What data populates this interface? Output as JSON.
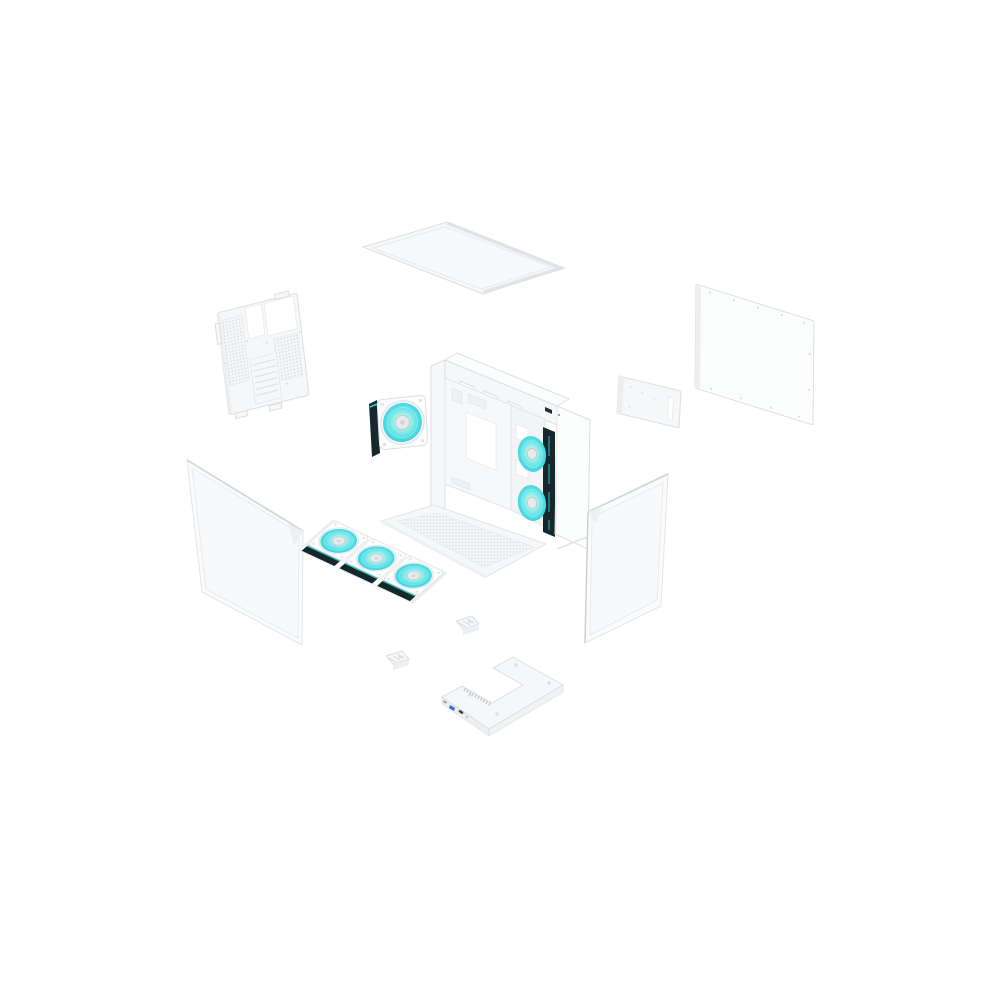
{
  "image": {
    "type": "product-render",
    "description": "Exploded isometric view of a white mid-tower ATX PC case on a white background: top dust-filter panel, vented steel side panel, solid side panel, tempered glass side and front panels, main chassis with motherboard tray and bottom mesh filter, one 120 mm turquoise ARGB rear fan, a bracket with three 120 mm turquoise ARGB fans, two small mounting brackets and a front I/O base frame with USB ports.",
    "background": "#ffffff"
  },
  "product": {
    "category": "PC case (mid-tower)",
    "finish": "white",
    "accent": "turquoise ARGB fans",
    "view": "exploded isometric"
  },
  "colors": {
    "background": "#ffffff",
    "panel_white": "#f6f7f8",
    "panel_bright": "#fcfdfd",
    "panel_shade": "#eceef0",
    "edge_line": "#dcdfe1",
    "mesh_bg": "#f3f5f6",
    "mesh_dot": "#d9dde0",
    "fan_blade": "#4fdce4",
    "fan_blade_light": "#aef2ec",
    "fan_ring": "#7debe7",
    "fan_hub": "#e7eaec",
    "fan_hub_ring": "#c3c8cb",
    "fan_side_dark": "#16282b",
    "fan_side_accent": "#2fd0d2",
    "glass_fill": "#fafbfc",
    "glass_edge": "#e3e5e7",
    "usb_blue": "#2e6fe0",
    "port_dark": "#3a3f44"
  },
  "parts": [
    {
      "id": "top-panel",
      "label": "Top panel / dust filter"
    },
    {
      "id": "vented-side-panel",
      "label": "Vented steel side panel"
    },
    {
      "id": "solid-side-panel",
      "label": "Solid side panel"
    },
    {
      "id": "rear-fan",
      "label": "120 mm ARGB fan"
    },
    {
      "id": "chassis",
      "label": "Main chassis frame with motherboard tray"
    },
    {
      "id": "rear-bracket-panel",
      "label": "Rear bracket panel"
    },
    {
      "id": "side-glass",
      "label": "Tempered glass side panel"
    },
    {
      "id": "front-glass",
      "label": "Tempered glass front panel"
    },
    {
      "id": "fan-bracket",
      "label": "Triple 120 mm ARGB fan bracket"
    },
    {
      "id": "mounting-bracket-1",
      "label": "Mounting bracket"
    },
    {
      "id": "mounting-bracket-2",
      "label": "Mounting bracket"
    },
    {
      "id": "front-base-frame",
      "label": "Front I/O base frame"
    }
  ]
}
